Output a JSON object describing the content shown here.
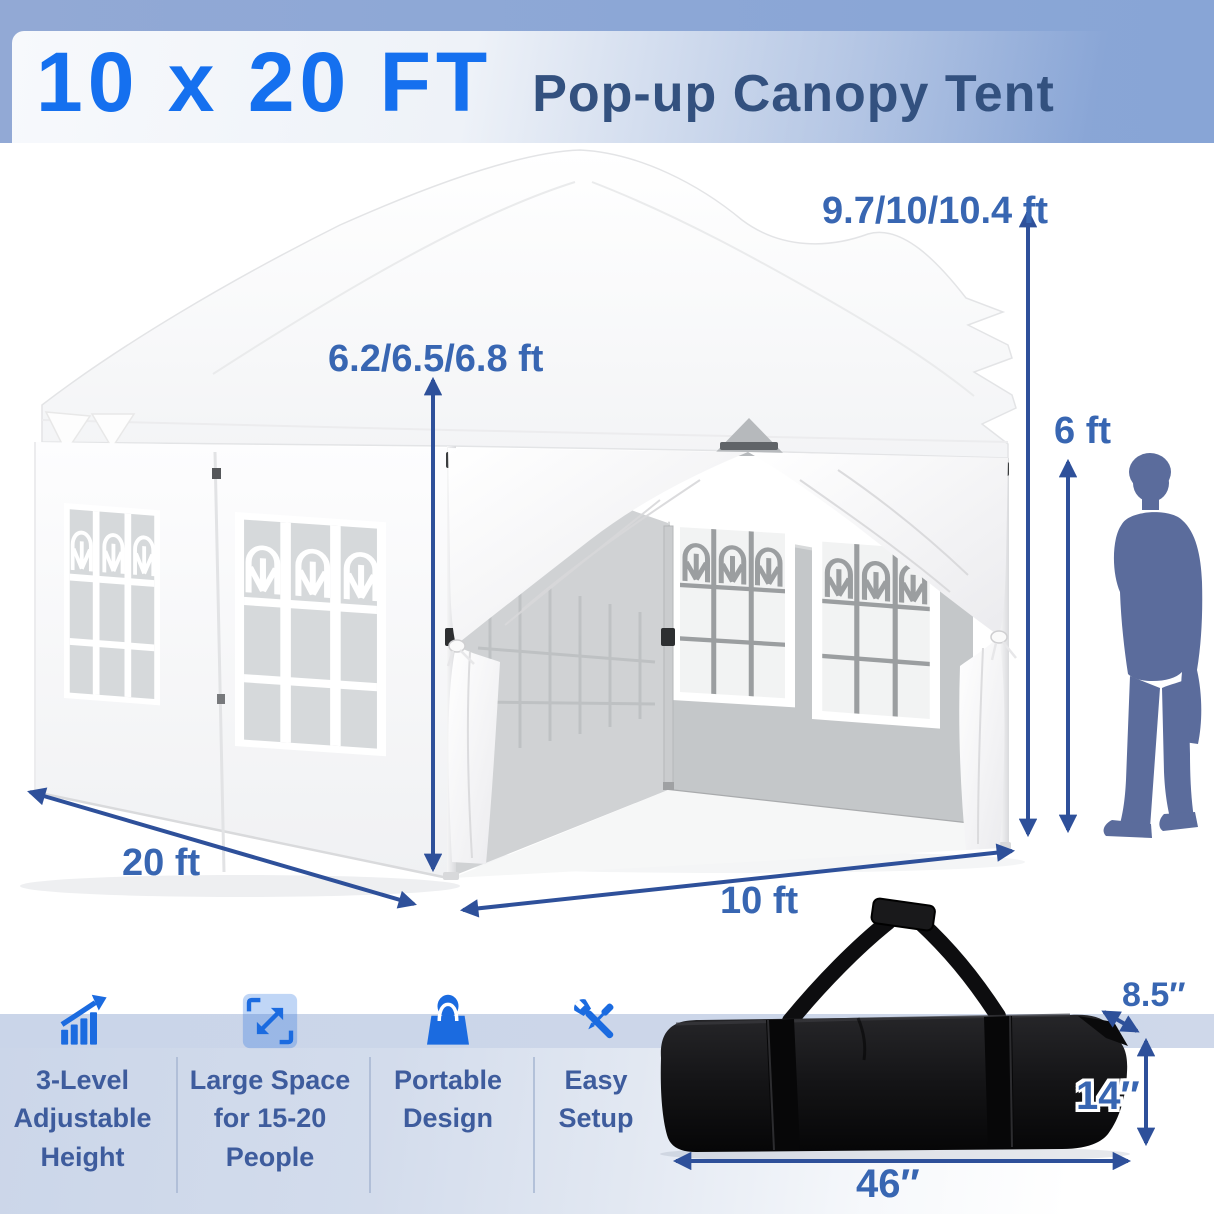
{
  "header": {
    "size_label": "10 x 20 FT",
    "product_label": "Pop-up Canopy Tent"
  },
  "tent_dimensions": {
    "peak_height": "9.7/10/10.4 ft",
    "side_height": "6.2/6.5/6.8 ft",
    "person_height": "6 ft",
    "side_length": "20 ft",
    "front_width": "10 ft"
  },
  "storage_bag": {
    "depth": "8.5″",
    "height": "14″",
    "length": "46″"
  },
  "features": [
    {
      "icon": "growth-chart-icon",
      "label": "3-Level Adjustable Height"
    },
    {
      "icon": "expand-arrows-icon",
      "label": "Large Space for 15-20 People"
    },
    {
      "icon": "tote-bag-icon",
      "label": "Portable Design"
    },
    {
      "icon": "tools-icon",
      "label": "Easy Setup"
    }
  ],
  "colors": {
    "accent_blue": "#1570ef",
    "title_navy": "#33517f",
    "dimension_blue": "#3866b2",
    "arrow_blue": "#2e509a",
    "icon_blue": "#1b6be0",
    "feature_text": "#3e5c9d",
    "person_silhouette": "#5b6c9c",
    "strip_blue": "#cbd6e9"
  }
}
